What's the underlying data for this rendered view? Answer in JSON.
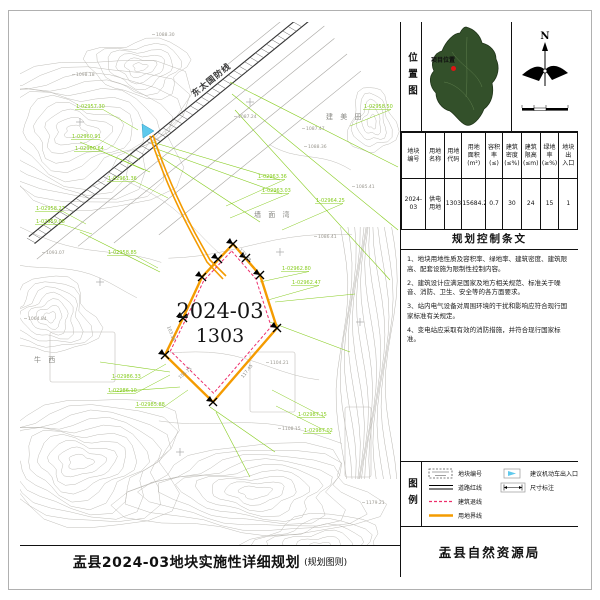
{
  "title_bar": {
    "title": "盂县2024-03地块实施性详细规划",
    "subtitle": "(规划图则)"
  },
  "bureau": "盂县自然资源局",
  "location": {
    "label": "位置图",
    "project_label": "项目位置",
    "north": "N"
  },
  "table": {
    "headers": [
      [
        "地块",
        "编号"
      ],
      [
        "用地",
        "名称"
      ],
      [
        "用地",
        "代码"
      ],
      [
        "用地",
        "面积",
        "(m²)"
      ],
      [
        "容积率",
        "(≤)"
      ],
      [
        "建筑",
        "密度",
        "(≤%)"
      ],
      [
        "建筑",
        "限高",
        "(≤m)"
      ],
      [
        "绿地率",
        "(≥%)"
      ],
      [
        "地块出",
        "入口"
      ]
    ],
    "row": [
      [
        "2024-03"
      ],
      [
        "供电",
        "用地"
      ],
      [
        "1303"
      ],
      [
        "15684.25"
      ],
      [
        "0.7"
      ],
      [
        "30"
      ],
      [
        "24"
      ],
      [
        "15"
      ],
      [
        "1"
      ]
    ]
  },
  "provisions": {
    "title": "规划控制条文",
    "items": [
      "1、地块用地性质及容积率、绿地率、建筑密度、建筑限高、配套设施为限制性控制内容。",
      "2、建筑设计应满足国家及地方相关规范、标准关于噪音、消防、卫生、安全等的各方面要求。",
      "3、站内电气设备对周围环境的干扰和影响应符合现行国家标准有关规定。",
      "4、变电站应采取有效的消防措施，并符合现行国家标准。"
    ]
  },
  "legend": {
    "label": "图例",
    "items_left": [
      {
        "label": "地块编号",
        "type": "parcel"
      },
      {
        "label": "道路红线",
        "type": "road"
      },
      {
        "label": "建筑退线",
        "type": "setback"
      },
      {
        "label": "用地界线",
        "type": "boundary"
      }
    ],
    "items_right": [
      {
        "label": "建议机动车出入口",
        "type": "entrance"
      },
      {
        "label": "尺寸标注",
        "type": "dimension"
      }
    ]
  },
  "map": {
    "parcel_code": "2024-03",
    "parcel_land_code": "1303",
    "road_label": "东太国防线",
    "place_names": [
      {
        "t": "建 美 田",
        "x": 306,
        "y": 97
      },
      {
        "t": "墙 面 湾",
        "x": 234,
        "y": 195
      },
      {
        "t": "牛  西",
        "x": 14,
        "y": 340
      }
    ],
    "green_labels": [
      {
        "t": "1-02957.30",
        "x": 56,
        "y": 86,
        "tx": 118,
        "ty": 108
      },
      {
        "t": "1-02960.91",
        "x": 52,
        "y": 116,
        "tx": 120,
        "ty": 138
      },
      {
        "t": "1-02960.64",
        "x": 55,
        "y": 128,
        "tx": 124,
        "ty": 148
      },
      {
        "t": "1-02961.36",
        "x": 88,
        "y": 158,
        "tx": 148,
        "ty": 176
      },
      {
        "t": "1-02958.27",
        "x": 16,
        "y": 188,
        "tx": 66,
        "ty": 202
      },
      {
        "t": "1-02959.08",
        "x": 16,
        "y": 201,
        "tx": 72,
        "ty": 212
      },
      {
        "t": "1-02958.85",
        "x": 88,
        "y": 232,
        "tx": 138,
        "ty": 246
      },
      {
        "t": "1-02963.36",
        "x": 238,
        "y": 156,
        "tx": 206,
        "ty": 184
      },
      {
        "t": "1-02963.03",
        "x": 242,
        "y": 170,
        "tx": 210,
        "ty": 196
      },
      {
        "t": "1-02964.25",
        "x": 296,
        "y": 180,
        "tx": 262,
        "ty": 208
      },
      {
        "t": "1-02958.50",
        "x": 344,
        "y": 86,
        "tx": 330,
        "ty": 104
      },
      {
        "t": "1-02962.80",
        "x": 262,
        "y": 248,
        "tx": 240,
        "ty": 260
      },
      {
        "t": "1-02962.47",
        "x": 272,
        "y": 262,
        "tx": 248,
        "ty": 278
      },
      {
        "t": "1-02986.33",
        "x": 92,
        "y": 356,
        "tx": 146,
        "ty": 342
      },
      {
        "t": "1-02986.10",
        "x": 88,
        "y": 370,
        "tx": 150,
        "ty": 353
      },
      {
        "t": "1-02985.88",
        "x": 116,
        "y": 384,
        "tx": 168,
        "ty": 368
      },
      {
        "t": "1-02987.15",
        "x": 278,
        "y": 394,
        "tx": 252,
        "ty": 368
      },
      {
        "t": "1-02987.02",
        "x": 284,
        "y": 410,
        "tx": 256,
        "ty": 384
      }
    ],
    "elevations": [
      {
        "t": "1088.30",
        "x": 136,
        "y": 14
      },
      {
        "t": "1098.18",
        "x": 56,
        "y": 54
      },
      {
        "t": "1087.24",
        "x": 218,
        "y": 96
      },
      {
        "t": "1087.47",
        "x": 286,
        "y": 108
      },
      {
        "t": "1088.36",
        "x": 288,
        "y": 126
      },
      {
        "t": "1085.41",
        "x": 336,
        "y": 166
      },
      {
        "t": "1086.41",
        "x": 298,
        "y": 216
      },
      {
        "t": "1093.07",
        "x": 26,
        "y": 232
      },
      {
        "t": "1064.84",
        "x": 8,
        "y": 298
      },
      {
        "t": "1104.21",
        "x": 250,
        "y": 342
      },
      {
        "t": "1108.15",
        "x": 262,
        "y": 408
      },
      {
        "t": "1179.21",
        "x": 346,
        "y": 482
      }
    ],
    "edge_lengths": [
      {
        "t": "172.78",
        "x": 224,
        "y": 234,
        "r": 49
      },
      {
        "t": "103.18",
        "x": 150,
        "y": 312,
        "r": 68
      },
      {
        "t": "155.75",
        "x": 166,
        "y": 352,
        "r": -40
      },
      {
        "t": "117.45",
        "x": 228,
        "y": 350,
        "r": -52
      }
    ],
    "colors": {
      "boundary": "#F49B00",
      "setback": "#ED2E6B",
      "cadastral": "#86CC1E",
      "contour": "#B8B5B0",
      "entrance_blue": "#5FC9EC"
    }
  }
}
